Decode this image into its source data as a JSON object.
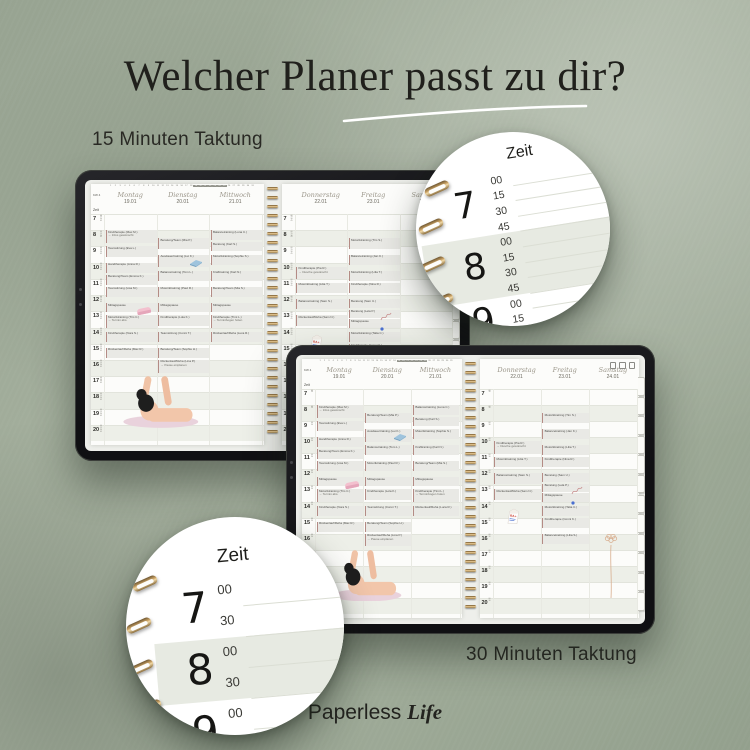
{
  "page": {
    "title": "Welcher Planer passt zu dir?",
    "label_15min": "15 Minuten Taktung",
    "label_30min": "30 Minuten Taktung",
    "brand_first": "Paperless",
    "brand_second": "Life"
  },
  "colors": {
    "background_sage": "#9aa694",
    "tablet_frame": "#161618",
    "page_white": "#fcfcfa",
    "hour_band": "#edefe8",
    "event_bg": "#e9e9e5",
    "event_bar": "#b48b85",
    "script_header": "#9b968a",
    "spiral_gold": "#caa366"
  },
  "callouts": {
    "c15": {
      "zeit_label": "Zeit",
      "rows": [
        "00",
        "15",
        "30",
        "45",
        "00",
        "15",
        "30",
        "45",
        "00",
        "15",
        "30"
      ],
      "hours": [
        {
          "h": "7",
          "from": 0,
          "to": 3,
          "shaded": false
        },
        {
          "h": "8",
          "from": 4,
          "to": 7,
          "shaded": true
        },
        {
          "h": "9",
          "from": 8,
          "to": 10,
          "shaded": false
        }
      ]
    },
    "c30": {
      "zeit_label": "Zeit",
      "rows": [
        "00",
        "30",
        "00",
        "30",
        "00",
        "30"
      ],
      "hours": [
        {
          "h": "7",
          "from": 0,
          "to": 1,
          "shaded": false
        },
        {
          "h": "8",
          "from": 2,
          "to": 3,
          "shaded": true
        },
        {
          "h": "9",
          "from": 4,
          "to": 5,
          "shaded": false
        }
      ]
    }
  },
  "planner": {
    "kw_label": "KW 4",
    "zeit_label": "Zeit",
    "date_strip": {
      "from": 1,
      "to": 31,
      "highlight_from": 19,
      "highlight_to": 25
    },
    "days": [
      {
        "name": "Montag",
        "date": "19.01"
      },
      {
        "name": "Dienstag",
        "date": "20.01"
      },
      {
        "name": "Mittwoch",
        "date": "21.01"
      },
      {
        "name": "Donnerstag",
        "date": "22.01"
      },
      {
        "name": "Freitag",
        "date": "23.01"
      },
      {
        "name": "Samstag",
        "date": "24.01"
      }
    ],
    "hour_start": 7,
    "hour_end": 20,
    "minutes_15": [
      "00",
      "15",
      "30",
      "45"
    ],
    "minutes_30": [
      "00",
      "30"
    ],
    "events": [
      {
        "d": 0,
        "s": 8.0,
        "dur": 0.75,
        "t": "Kindtherapie (Max M.)",
        "n": "→ Infos gewünscht"
      },
      {
        "d": 0,
        "s": 9.0,
        "dur": 0.6,
        "t": "Teamsitzung (Eva L.)"
      },
      {
        "d": 0,
        "s": 10.0,
        "dur": 0.6,
        "t": "Handtherapie (Anna R.)"
      },
      {
        "d": 0,
        "s": 10.75,
        "dur": 0.6,
        "t": "Beratung/Team (Emma K.)"
      },
      {
        "d": 0,
        "s": 11.5,
        "dur": 0.6,
        "t": "Teamsitzung (Lisa M.)"
      },
      {
        "d": 0,
        "s": 12.5,
        "dur": 0.5,
        "t": "Mittagspause",
        "sticker": "eraser"
      },
      {
        "d": 0,
        "s": 13.25,
        "dur": 0.75,
        "t": "Motoriktraining (Tim C.)",
        "n": "→ Termin abs."
      },
      {
        "d": 0,
        "s": 14.25,
        "dur": 0.6,
        "t": "Kindtherapie (Nora S.)"
      },
      {
        "d": 0,
        "s": 15.25,
        "dur": 0.6,
        "t": "Rückenlauf/Reha (Max R.)"
      },
      {
        "d": 1,
        "s": 8.5,
        "dur": 0.6,
        "t": "Beratung/Team (Mia P.)"
      },
      {
        "d": 1,
        "s": 9.5,
        "dur": 0.75,
        "t": "Ausdauertraining (Lui K.)",
        "sticker": "book"
      },
      {
        "d": 1,
        "s": 10.5,
        "dur": 0.6,
        "t": "Balancetraining (Tom L.)"
      },
      {
        "d": 1,
        "s": 11.5,
        "dur": 0.6,
        "t": "Motoriktraining (Paul R.)"
      },
      {
        "d": 1,
        "s": 12.5,
        "dur": 0.5,
        "t": "Mittagspause"
      },
      {
        "d": 1,
        "s": 13.25,
        "dur": 0.6,
        "t": "Kindtherapie (Lola K.)"
      },
      {
        "d": 1,
        "s": 14.25,
        "dur": 0.6,
        "t": "Teamsitzung (Conni T.)"
      },
      {
        "d": 1,
        "s": 15.25,
        "dur": 0.6,
        "t": "Beratung/Team (Sophie H.)"
      },
      {
        "d": 1,
        "s": 16.0,
        "dur": 0.75,
        "t": "Rückenlauf/Reha (Lina P.)",
        "n": "→ Pause einplanen"
      },
      {
        "d": 2,
        "s": 8.0,
        "dur": 0.6,
        "t": "Balancetraining (Luna C.)"
      },
      {
        "d": 2,
        "s": 8.75,
        "dur": 0.5,
        "t": "Beratung (Karl S.)"
      },
      {
        "d": 2,
        "s": 9.5,
        "dur": 0.6,
        "t": "Motoriktraining (Sophie S.)"
      },
      {
        "d": 2,
        "s": 10.5,
        "dur": 0.6,
        "t": "Krafttraining (Karl N.)"
      },
      {
        "d": 2,
        "s": 11.5,
        "dur": 0.6,
        "t": "Beratung/Team (Mia S.)"
      },
      {
        "d": 2,
        "s": 12.5,
        "dur": 0.5,
        "t": "Mittagspause"
      },
      {
        "d": 2,
        "s": 13.25,
        "dur": 0.75,
        "t": "Kindtherapie (Timi L.)",
        "n": "→ Terminbogen holen"
      },
      {
        "d": 2,
        "s": 14.25,
        "dur": 0.6,
        "t": "Rückenlauf/Reha (Luca R.)"
      },
      {
        "d": 3,
        "s": 10.25,
        "dur": 0.75,
        "t": "Kindtherapie (Pia R.)",
        "n": "→ Dusche gewünscht"
      },
      {
        "d": 3,
        "s": 11.25,
        "dur": 0.6,
        "t": "Motoriktraining (Lilia T.)"
      },
      {
        "d": 3,
        "s": 12.25,
        "dur": 0.6,
        "t": "Balancetraining (Sam S.)"
      },
      {
        "d": 3,
        "s": 13.25,
        "dur": 0.6,
        "t": "Rückenlauf/Reha (Sam N.)"
      },
      {
        "d": 3,
        "s": 14.4,
        "dur": 1.4,
        "t": "",
        "sticker": "milk"
      },
      {
        "d": 4,
        "s": 8.5,
        "dur": 0.6,
        "t": "Motoriktraining (Tim S.)"
      },
      {
        "d": 4,
        "s": 9.5,
        "dur": 0.6,
        "t": "Balancetraining (Jan K.)"
      },
      {
        "d": 4,
        "s": 10.5,
        "dur": 0.6,
        "t": "Motoriktraining (Lilia T.)"
      },
      {
        "d": 4,
        "s": 11.25,
        "dur": 0.6,
        "t": "Kindtherapie (Nina R.)"
      },
      {
        "d": 4,
        "s": 12.25,
        "dur": 0.5,
        "t": "Beratung (Sam U.)"
      },
      {
        "d": 4,
        "s": 12.9,
        "dur": 0.5,
        "t": "Beratung (Lela P.)",
        "sticker": "squiggle"
      },
      {
        "d": 4,
        "s": 13.5,
        "dur": 0.5,
        "t": "Mittagspause",
        "sticker": "bluedot"
      },
      {
        "d": 4,
        "s": 14.25,
        "dur": 0.6,
        "t": "Motoriktraining (Talia C.)"
      },
      {
        "d": 4,
        "s": 15.0,
        "dur": 0.6,
        "t": "Kindtherapie (Conni K.)"
      },
      {
        "d": 4,
        "s": 16.0,
        "dur": 0.6,
        "t": "Balancetraining (Lilia S.)"
      },
      {
        "d": 5,
        "s": 16.0,
        "dur": 4.0,
        "t": "",
        "sticker": "flower"
      }
    ]
  }
}
